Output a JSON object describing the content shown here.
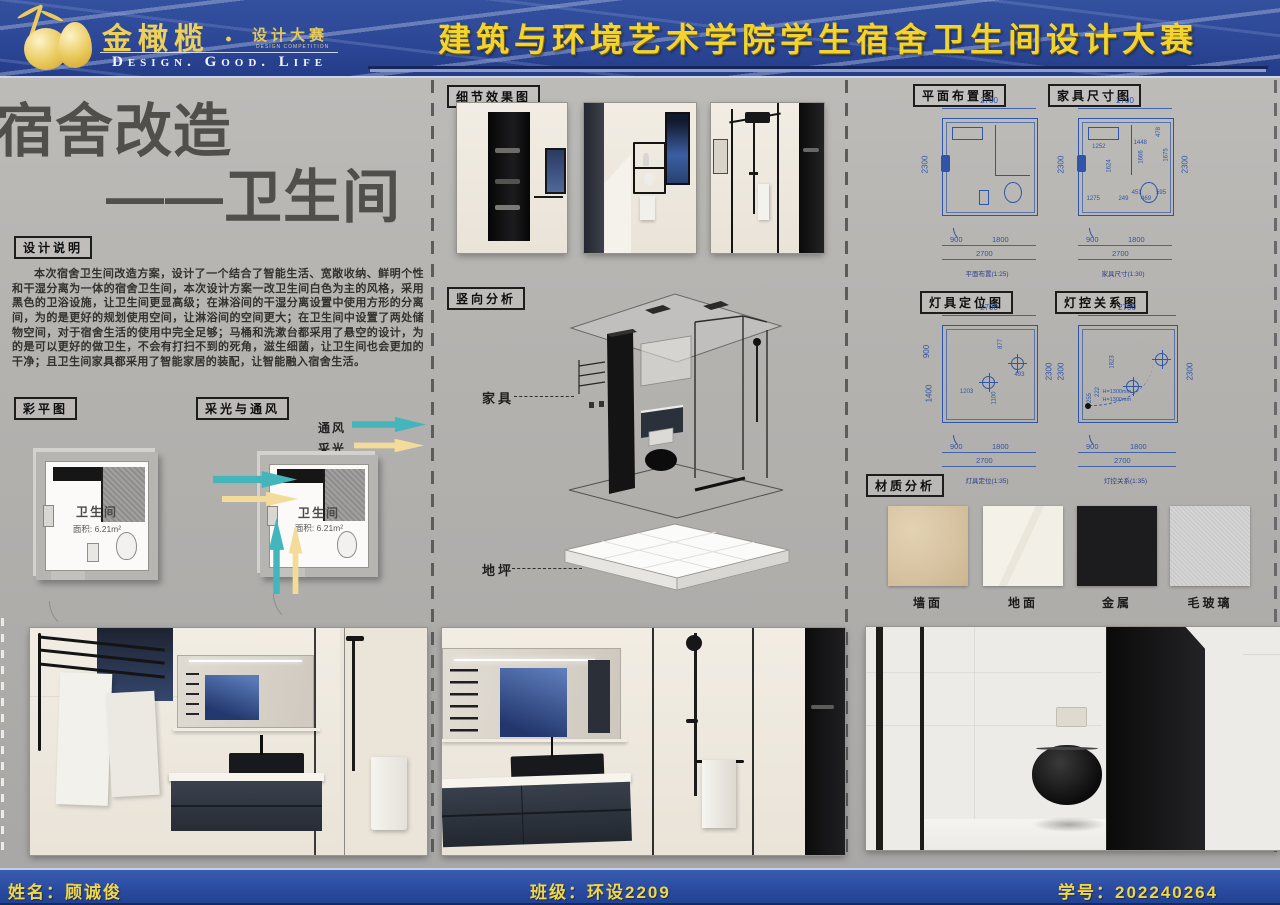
{
  "header": {
    "brand": {
      "cn": "金橄榄 ·",
      "sub": "设计大赛",
      "sub_en": "DESIGN COMPETITION",
      "slogan": "Design.  Good.  Life"
    },
    "title": "建筑与环境艺术学院学生宿舍卫生间设计大赛"
  },
  "left": {
    "title_line1": "宿舍改造",
    "title_line2": "——卫生间",
    "design_notes_label": "设计说明",
    "design_notes": "本次宿舍卫生间改造方案，设计了一个结合了智能生活、宽敞收纳、鲜明个性和干湿分离为一体的宿舍卫生间，本次设计方案一改卫生间白色为主的风格，采用黑色的卫浴设施，让卫生间更显高级；在淋浴间的干湿分离设置中使用方形的分离间，为的是更好的规划使用空间，让淋浴间的空间更大；在卫生间中设置了两处储物空间，对于宿舍生活的使用中完全足够；马桶和洗漱台都采用了悬空的设计，为的是可以更好的做卫生，不会有打扫不到的死角，滋生细菌，让卫生间也会更加的干净；且卫生间家具都采用了智能家居的装配，让智能融入宿舍生活。",
    "color_plan_label": "彩平图",
    "light_vent_label": "采光与通风",
    "legend": {
      "vent": "通风",
      "light": "采光"
    },
    "room": {
      "name": "卫生间",
      "area": "面积: 6.21m²"
    }
  },
  "middle": {
    "detail_label": "细节效果图",
    "vertical_label": "竖向分析",
    "furniture_label": "家具",
    "floor_label": "地坪"
  },
  "right": {
    "plan_layout": {
      "label": "平面布置图",
      "caption": "平面布置(1:25)",
      "dim_top": "2700",
      "dim_side": "2300",
      "dim_b1": "900",
      "dim_b2": "1800",
      "dim_b3": "2700"
    },
    "furniture_plan": {
      "label": "家具尺寸图",
      "caption": "家具尺寸(1:30)",
      "dim_top": "2700",
      "dim_side": "2300",
      "dim_side_r": "2300",
      "dim_b1": "900",
      "dim_b2": "1800",
      "dim_b3": "2700",
      "inner": [
        "1252",
        "1448",
        "478",
        "1675",
        "1666",
        "1624",
        "1275",
        "249",
        "451",
        "469",
        "595"
      ]
    },
    "light_position": {
      "label": "灯具定位图",
      "caption": "灯具定位(1:35)",
      "dim_top": "2700",
      "dim_l1": "900",
      "dim_l2": "1400",
      "dim_side_r": "2300",
      "dim_b1": "900",
      "dim_b2": "1800",
      "dim_b3": "2700",
      "inner": [
        "877",
        "493",
        "1203",
        "1100"
      ]
    },
    "light_control": {
      "label": "灯控关系图",
      "caption": "灯控关系(1:35)",
      "dim_top": "2700",
      "dim_side": "2300",
      "dim_side_r": "2300",
      "dim_b1": "900",
      "dim_b2": "1800",
      "dim_b3": "2700",
      "inner": [
        "1823",
        "222",
        "255"
      ],
      "h1": "H=1300mm",
      "h2": "H=1300mm"
    },
    "materials": {
      "label": "材质分析",
      "items": [
        {
          "name": "墙面"
        },
        {
          "name": "地面"
        },
        {
          "name": "金属"
        },
        {
          "name": "毛玻璃"
        }
      ]
    }
  },
  "footer": {
    "name": "姓名：顾诚俊",
    "class": "班级：环设2209",
    "student_id": "学号：202240264"
  },
  "colors": {
    "banner_blue": "#2c4796",
    "gold_text": "#f2d431",
    "cad_blue": "#2f55a8",
    "vent_teal": "#45b5bc",
    "daylight_yellow": "#f3dc9a",
    "poster_gray": "#b4b2af"
  }
}
